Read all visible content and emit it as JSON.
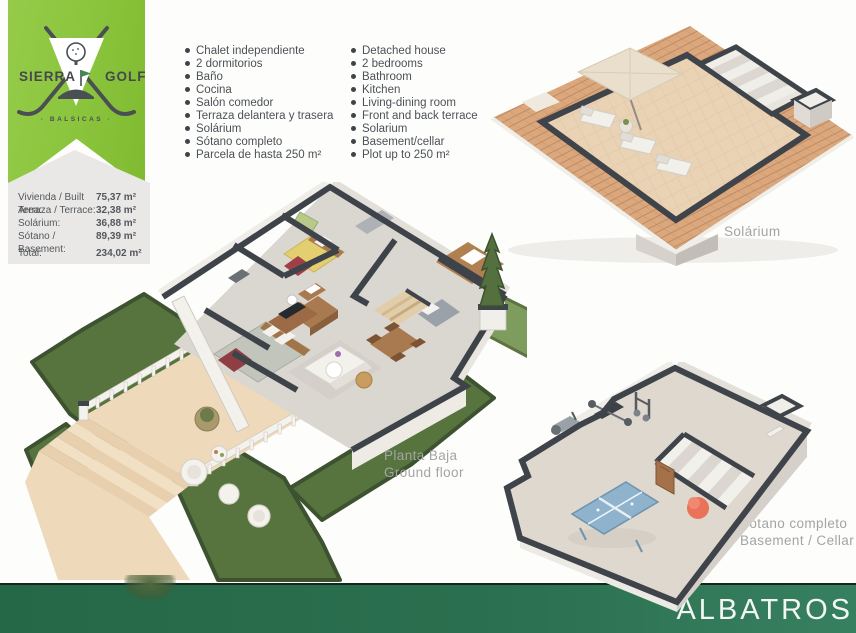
{
  "logo": {
    "word1": "SIERRA",
    "word2": "GOLF",
    "subtitle": "· BALSICAS ·"
  },
  "areas_table": {
    "rows": [
      {
        "label": "Vivienda / Built Area:",
        "value": "75,37 m²"
      },
      {
        "label": "Terraza / Terrace:",
        "value": "32,38 m²"
      },
      {
        "label": "Solárium:",
        "value": "36,88 m²"
      },
      {
        "label": "Sótano / Basement:",
        "value": "89,39 m²"
      }
    ],
    "total": {
      "label": "Total:",
      "value": "234,02 m²"
    }
  },
  "features": {
    "es": {
      "items": [
        "Chalet independiente",
        "2 dormitorios",
        "Baño",
        "Cocina",
        "Salón comedor",
        "Terraza delantera y trasera",
        "Solárium",
        "Sótano completo",
        "Parcela de hasta 250 m²"
      ]
    },
    "en": {
      "items": [
        "Detached house",
        "2 bedrooms",
        "Bathroom",
        "Kitchen",
        "Living-dining room",
        "Front and back terrace",
        "Solarium",
        "Basement/cellar",
        "Plot up to 250 m²"
      ]
    }
  },
  "plans": {
    "solarium": {
      "label": "Solárium"
    },
    "ground": {
      "label_line1": "Planta Baja",
      "label_line2": "Ground floor"
    },
    "basement": {
      "label_line1": "Sótano completo",
      "label_line2": "Basement / Cellar"
    }
  },
  "footer": {
    "title": "ALBATROS"
  },
  "colors": {
    "ribbon_green": "#8ac43c",
    "footer_green": "#2a6f4f",
    "grass_green": "#57743f",
    "bright_lawn_green": "#7f9c5f",
    "roof_tile": "#dba87d",
    "terrace_tan": "#eed9bb",
    "wall_top_charcoal": "#3f444a",
    "logo_text": "#45494e",
    "body_text": "#4c5157",
    "plan_label_gray": "#a4a4a2"
  }
}
